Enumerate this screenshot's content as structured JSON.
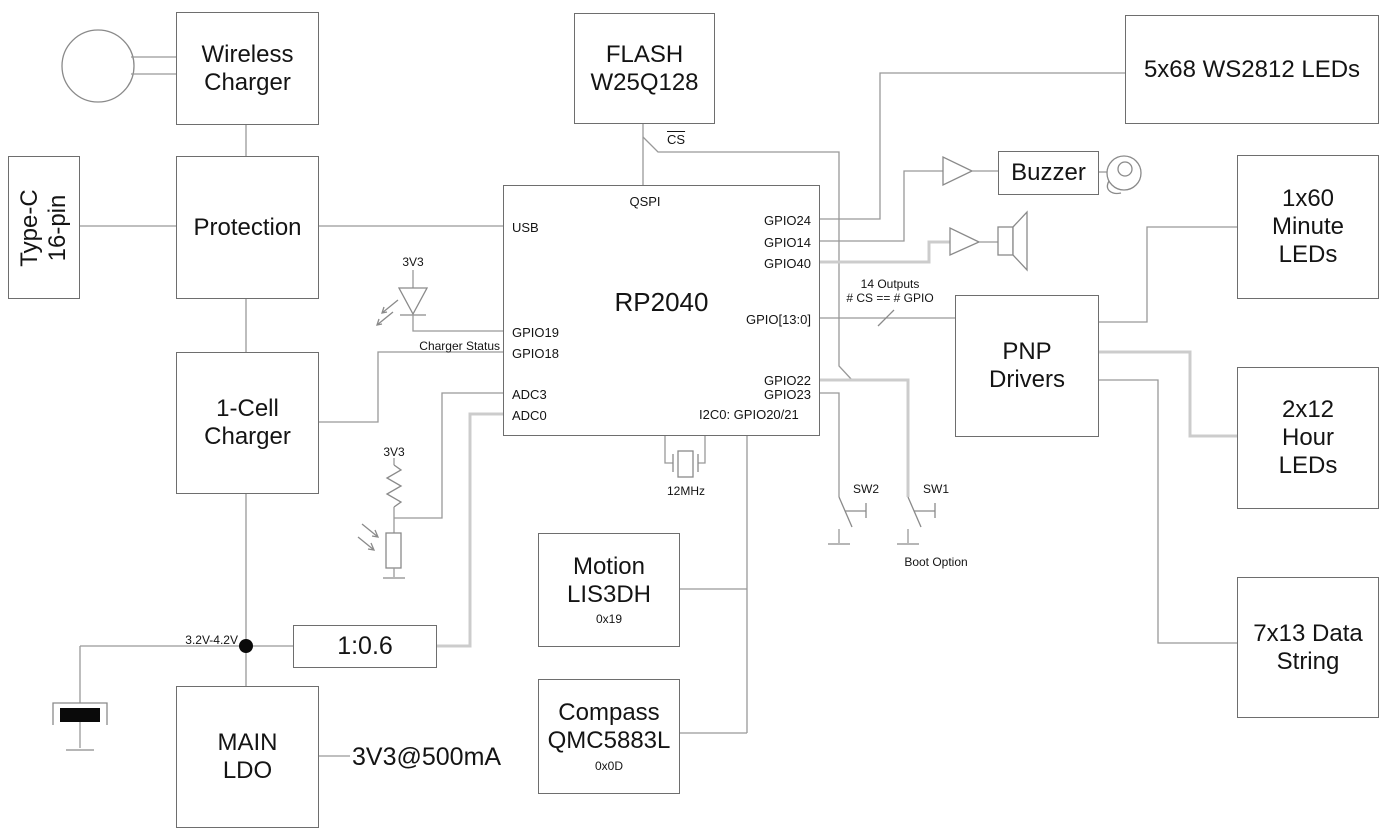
{
  "blocks": {
    "wireless": "Wireless\nCharger",
    "typec": "Type-C\n16-pin",
    "protection": "Protection",
    "onecell": "1-Cell\nCharger",
    "mainldo": "MAIN\nLDO",
    "ratio": "1:0.6",
    "flash": "FLASH\nW25Q128",
    "rp2040": "RP2040",
    "motion": "Motion\nLIS3DH",
    "motion_addr": "0x19",
    "compass": "Compass\nQMC5883L",
    "compass_addr": "0x0D",
    "buzzer": "Buzzer",
    "pnp": "PNP\nDrivers",
    "ws2812": "5x68 WS2812 LEDs",
    "minute": "1x60\nMinute\nLEDs",
    "hour": "2x12\nHour\nLEDs",
    "datastring": "7x13 Data\nString"
  },
  "rp2040_pins": {
    "qspi": "QSPI",
    "usb": "USB",
    "gpio19": "GPIO19",
    "gpio18": "GPIO18",
    "adc3": "ADC3",
    "adc0": "ADC0",
    "gpio24": "GPIO24",
    "gpio14": "GPIO14",
    "gpio40": "GPIO40",
    "gpio_bus": "GPIO[13:0]",
    "gpio22": "GPIO22",
    "gpio23": "GPIO23",
    "i2c0": "I2C0: GPIO20/21"
  },
  "labels": {
    "v33": "3V3",
    "charger_status": "Charger Status",
    "xtal": "12MHz",
    "cs": "CS",
    "sw2": "SW2",
    "sw1": "SW1",
    "boot": "Boot Option",
    "outputs": "14 Outputs\n# CS == # GPIO",
    "vbat": "3.2V-4.2V",
    "ldo_out": "3V3@500mA"
  },
  "colors": {
    "wire": "#999999",
    "wire_highlight": "#cccccc",
    "box_border": "#6e6e6e",
    "text": "#141414",
    "solid_black": "#0a0a0a",
    "background": "#ffffff"
  }
}
